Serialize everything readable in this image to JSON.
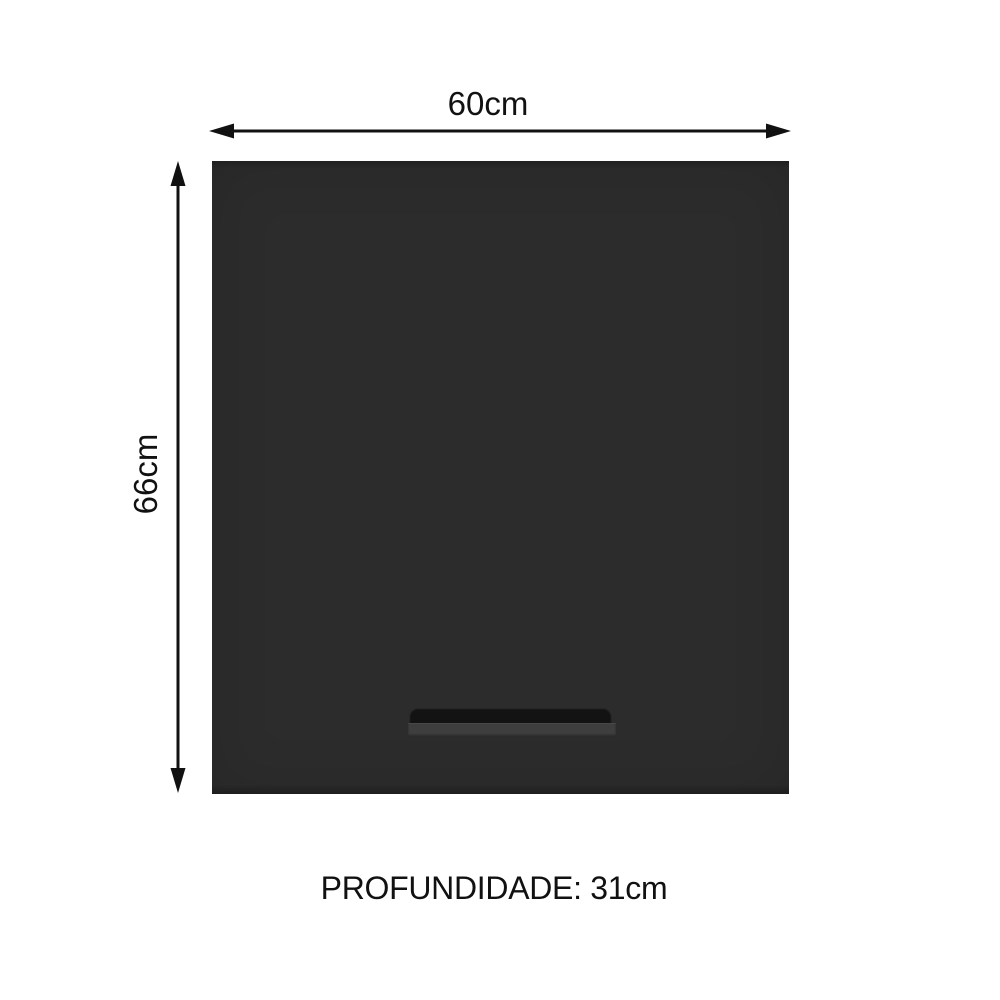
{
  "diagram": {
    "width_label": "60cm",
    "height_label": "66cm",
    "depth_label": "PROFUNDIDADE: 31cm",
    "colors": {
      "background": "#ffffff",
      "cabinet_body": "#2c2c2c",
      "cabinet_edge_top": "#232323",
      "cabinet_edge_bottom": "#202020",
      "handle_recess": "#131313",
      "handle_bar": "#3e3e3e",
      "line": "#111111",
      "text": "#111111"
    }
  }
}
